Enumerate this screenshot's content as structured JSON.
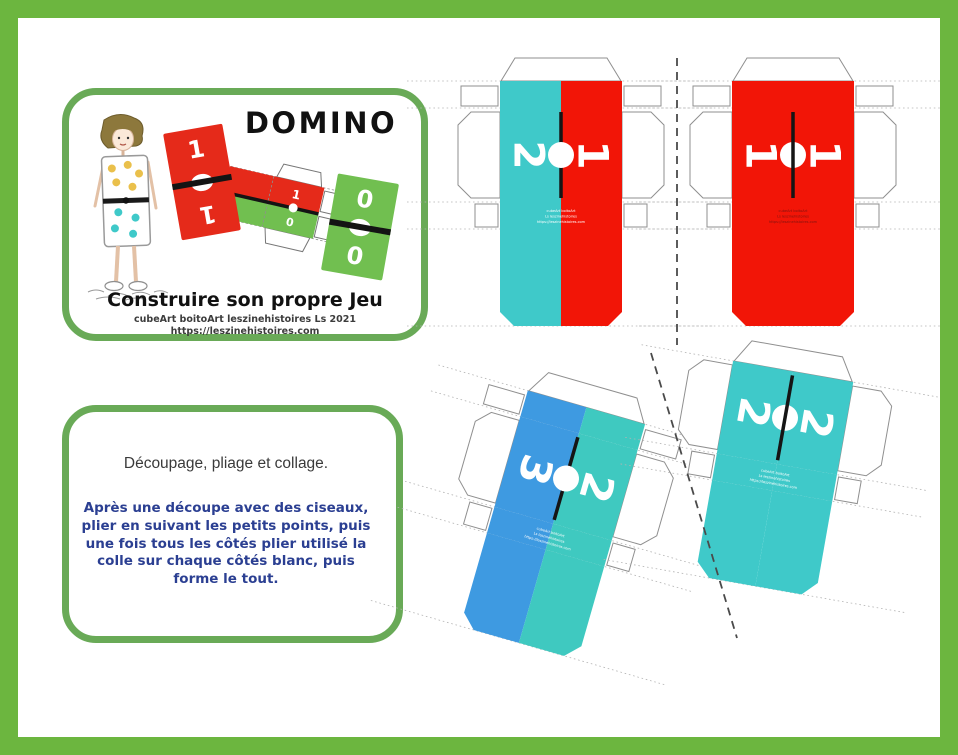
{
  "page": {
    "frame_color": "#6cb63f",
    "background": "#ffffff"
  },
  "title_card": {
    "title": "DOMINO",
    "subtitle": "Construire son propre Jeu",
    "credit_line1": "cubeArt boitoArt leszinehistoires Ls 2021",
    "credit_line2": "https://leszinehistoires.com",
    "dominoes": [
      {
        "top": "1",
        "bottom": "1",
        "color": "#e52a1a"
      },
      {
        "top": "0",
        "bottom": "0",
        "color": "#71bf50"
      }
    ],
    "mini_net": {
      "top_label": "1",
      "bottom_label": "0",
      "top_color": "#e52a1a",
      "bottom_color": "#71bf50"
    }
  },
  "instructions_card": {
    "heading": "Découpage, pliage et collage.",
    "body": "Après une découpe avec des ciseaux, plier en suivant les petits points, puis une fois tous les côtés plier utilisé la colle sur chaque côtés blanc, puis forme le tout.",
    "text_color": "#2b3f92"
  },
  "templates": [
    {
      "id": "net-2-1",
      "left_label": "2",
      "right_label": "1",
      "left_color": "#3fc9c9",
      "right_color": "#f21507",
      "watermark": "light"
    },
    {
      "id": "net-1-1",
      "left_label": "1",
      "right_label": "1",
      "left_color": "#f21507",
      "right_color": "#f21507",
      "watermark": "dark"
    },
    {
      "id": "net-3-2",
      "left_label": "3",
      "right_label": "2",
      "left_color": "#3e9ae1",
      "right_color": "#3fc9c0",
      "watermark": "light"
    },
    {
      "id": "net-2-2",
      "left_label": "2",
      "right_label": "2",
      "left_color": "#3fc9c9",
      "right_color": "#3fc9c9",
      "watermark": "light"
    }
  ],
  "watermark_lines": [
    "cubeArt boitoArt",
    "Ls leszinehistoires",
    "https://leszinehistoires.com"
  ],
  "watermark_colors": {
    "light": "#ffffff",
    "dark": "#7c1410"
  }
}
